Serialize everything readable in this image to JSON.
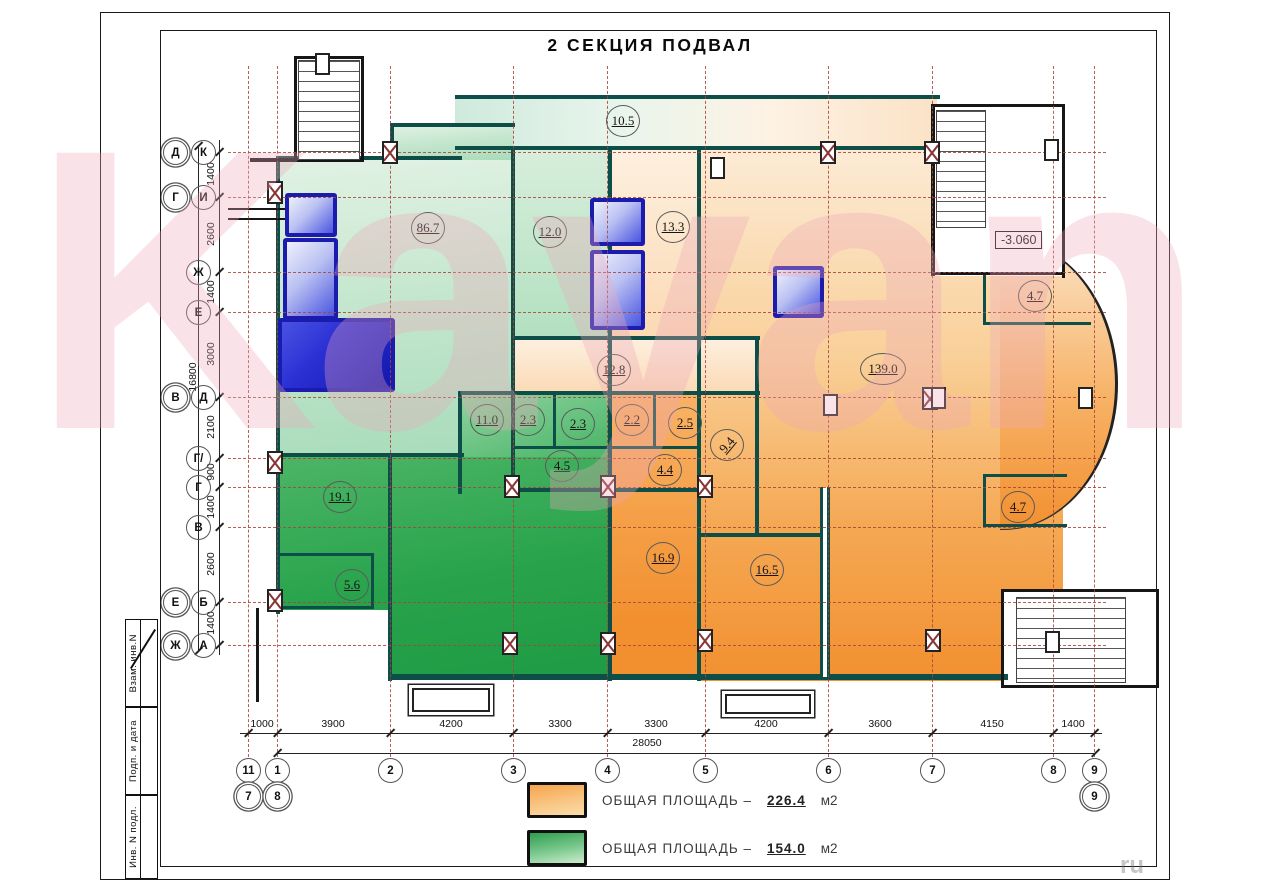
{
  "title": "2 СЕКЦИЯ ПОДВАЛ",
  "watermark": "Kayan",
  "watermark_small": "ru",
  "elevation": "-3.060",
  "legend": {
    "items": [
      {
        "color": "orange",
        "label": "ОБЩАЯ ПЛОЩАДЬ –",
        "value": "226.4",
        "unit": "м2"
      },
      {
        "color": "green",
        "label": "ОБЩАЯ ПЛОЩАДЬ –",
        "value": "154.0",
        "unit": "м2"
      }
    ]
  },
  "titleblock": {
    "cells": [
      "Взам. инв.N",
      "Подп. и дата",
      "Инв. N подл."
    ]
  },
  "rooms": [
    {
      "area": "10.5",
      "x": 623,
      "y": 121
    },
    {
      "area": "86.7",
      "x": 428,
      "y": 228
    },
    {
      "area": "12.0",
      "x": 550,
      "y": 232
    },
    {
      "area": "13.3",
      "x": 673,
      "y": 227
    },
    {
      "area": "12.8",
      "x": 614,
      "y": 370
    },
    {
      "area": "139.0",
      "x": 883,
      "y": 369,
      "wide": true
    },
    {
      "area": "4.7",
      "x": 1035,
      "y": 296
    },
    {
      "area": "11.0",
      "x": 487,
      "y": 420
    },
    {
      "area": "2.3",
      "x": 528,
      "y": 420
    },
    {
      "area": "2.3",
      "x": 578,
      "y": 424
    },
    {
      "area": "2.2",
      "x": 632,
      "y": 420
    },
    {
      "area": "2.5",
      "x": 685,
      "y": 423
    },
    {
      "area": "9.4",
      "x": 727,
      "y": 445,
      "rot": true
    },
    {
      "area": "4.5",
      "x": 562,
      "y": 466
    },
    {
      "area": "4.4",
      "x": 665,
      "y": 470
    },
    {
      "area": "19.1",
      "x": 340,
      "y": 497
    },
    {
      "area": "5.6",
      "x": 352,
      "y": 585
    },
    {
      "area": "16.9",
      "x": 663,
      "y": 558
    },
    {
      "area": "16.5",
      "x": 767,
      "y": 570
    },
    {
      "area": "4.7",
      "x": 1018,
      "y": 507
    }
  ],
  "axes": {
    "left": [
      {
        "a": "Д",
        "b": "К",
        "y": 152
      },
      {
        "a": "Г",
        "b": "И",
        "y": 197
      },
      {
        "a": "Ж",
        "y": 272
      },
      {
        "a": "Е",
        "y": 312
      },
      {
        "a": "В",
        "b": "Д",
        "y": 397
      },
      {
        "a": "Г/",
        "y": 458
      },
      {
        "a": "Г",
        "y": 487
      },
      {
        "a": "В",
        "y": 527
      },
      {
        "a": "Е",
        "b": "Б",
        "y": 602
      },
      {
        "a": "Ж",
        "b": "А",
        "y": 645
      }
    ],
    "bottom": [
      {
        "n": "11",
        "x": 248,
        "m": "7"
      },
      {
        "n": "1",
        "x": 277,
        "m": "8"
      },
      {
        "n": "2",
        "x": 390
      },
      {
        "n": "3",
        "x": 513
      },
      {
        "n": "4",
        "x": 607
      },
      {
        "n": "5",
        "x": 705
      },
      {
        "n": "6",
        "x": 828
      },
      {
        "n": "7",
        "x": 932
      },
      {
        "n": "8",
        "x": 1053
      },
      {
        "n": "9",
        "x": 1094,
        "m": "9"
      }
    ]
  },
  "dims": {
    "bottom": [
      {
        "v": "1000",
        "x": 262
      },
      {
        "v": "3900",
        "x": 333
      },
      {
        "v": "4200",
        "x": 451
      },
      {
        "v": "3300",
        "x": 560
      },
      {
        "v": "3300",
        "x": 656
      },
      {
        "v": "4200",
        "x": 766
      },
      {
        "v": "3600",
        "x": 880
      },
      {
        "v": "4150",
        "x": 992
      },
      {
        "v": "1400",
        "x": 1073
      }
    ],
    "bottom_total": {
      "v": "28050",
      "x": 647,
      "y": 737
    },
    "left": [
      {
        "v": "1400",
        "y": 174
      },
      {
        "v": "2600",
        "y": 234
      },
      {
        "v": "1400",
        "y": 292
      },
      {
        "v": "3000",
        "y": 354
      },
      {
        "v": "2100",
        "y": 427
      },
      {
        "v": "900",
        "y": 472
      },
      {
        "v": "1400",
        "y": 507
      },
      {
        "v": "2600",
        "y": 564
      },
      {
        "v": "1400",
        "y": 623
      }
    ],
    "left_total": {
      "v": "16800",
      "x": 193,
      "y": 377
    }
  },
  "plan": {
    "zones": [
      {
        "t": "rb",
        "x": 700,
        "y": 148,
        "w": 365,
        "h": 533
      },
      {
        "t": "pe",
        "x": 610,
        "y": 148,
        "w": 90,
        "h": 192
      },
      {
        "t": "st",
        "x": 455,
        "y": 97,
        "w": 482,
        "h": 53
      },
      {
        "t": "lg",
        "x": 278,
        "y": 158,
        "w": 235,
        "h": 299
      },
      {
        "t": "lg",
        "x": 390,
        "y": 125,
        "w": 123,
        "h": 35
      },
      {
        "t": "lg2",
        "x": 513,
        "y": 148,
        "w": 97,
        "h": 192
      },
      {
        "t": "pe",
        "x": 513,
        "y": 338,
        "w": 245,
        "h": 57
      },
      {
        "t": "mg",
        "x": 458,
        "y": 395,
        "w": 152,
        "h": 97
      },
      {
        "t": "sg",
        "x": 278,
        "y": 457,
        "w": 332,
        "h": 221
      },
      {
        "t": "so",
        "x": 610,
        "y": 395,
        "w": 90,
        "h": 283
      },
      {
        "t": "wh",
        "x": 1063,
        "y": 78,
        "w": 140,
        "h": 622
      },
      {
        "t": "bu",
        "x": 1000,
        "y": 238,
        "w": 118,
        "h": 292
      },
      {
        "t": "wh",
        "x": 933,
        "y": 106,
        "w": 132,
        "h": 170
      },
      {
        "t": "wh",
        "x": 1001,
        "y": 591,
        "w": 158,
        "h": 97
      },
      {
        "t": "wh",
        "x": 258,
        "y": 610,
        "w": 132,
        "h": 92
      }
    ],
    "walls_teal": [
      [
        455,
        95,
        485,
        4
      ],
      [
        278,
        156,
        184,
        4
      ],
      [
        455,
        146,
        485,
        4
      ],
      [
        276,
        156,
        4,
        458
      ],
      [
        511,
        146,
        4,
        348
      ],
      [
        608,
        146,
        4,
        535
      ],
      [
        697,
        146,
        4,
        535
      ],
      [
        511,
        336,
        249,
        4
      ],
      [
        458,
        391,
        302,
        4
      ],
      [
        458,
        391,
        4,
        103
      ],
      [
        276,
        453,
        188,
        4
      ],
      [
        553,
        395,
        3,
        54
      ],
      [
        653,
        395,
        3,
        54
      ],
      [
        511,
        446,
        190,
        3
      ],
      [
        511,
        488,
        190,
        4
      ],
      [
        755,
        336,
        4,
        200
      ],
      [
        697,
        533,
        128,
        4
      ],
      [
        276,
        553,
        98,
        3
      ],
      [
        276,
        606,
        98,
        3
      ],
      [
        371,
        553,
        3,
        55
      ],
      [
        388,
        453,
        4,
        228
      ],
      [
        388,
        674,
        620,
        6
      ],
      [
        983,
        273,
        3,
        52
      ],
      [
        983,
        322,
        108,
        3
      ],
      [
        983,
        474,
        3,
        53
      ],
      [
        983,
        474,
        84,
        3
      ],
      [
        983,
        524,
        84,
        3
      ],
      [
        390,
        123,
        125,
        4
      ],
      [
        390,
        123,
        4,
        37
      ]
    ],
    "wall_double": [
      [
        820,
        487,
        10,
        190
      ]
    ],
    "walls_black": [
      [
        294,
        56,
        3,
        106
      ],
      [
        361,
        56,
        3,
        106
      ],
      [
        294,
        56,
        70,
        3
      ],
      [
        250,
        158,
        114,
        4
      ],
      [
        931,
        106,
        4,
        170
      ],
      [
        931,
        104,
        134,
        3
      ],
      [
        1062,
        104,
        3,
        174
      ],
      [
        931,
        272,
        134,
        3
      ],
      [
        1001,
        589,
        3,
        99
      ],
      [
        1001,
        589,
        158,
        3
      ],
      [
        1156,
        589,
        3,
        99
      ],
      [
        1001,
        685,
        158,
        3
      ],
      [
        256,
        608,
        3,
        94
      ],
      [
        228,
        208,
        74,
        2
      ],
      [
        228,
        218,
        74,
        2
      ]
    ],
    "shafts": [
      {
        "x": 285,
        "y": 193,
        "w": 52,
        "h": 44
      },
      {
        "x": 283,
        "y": 238,
        "w": 55,
        "h": 82
      },
      {
        "x": 278,
        "y": 318,
        "w": 117,
        "h": 74,
        "deep": true
      },
      {
        "x": 590,
        "y": 198,
        "w": 55,
        "h": 48
      },
      {
        "x": 590,
        "y": 250,
        "w": 55,
        "h": 80
      },
      {
        "x": 773,
        "y": 266,
        "w": 51,
        "h": 52
      }
    ],
    "stairs": [
      [
        298,
        60,
        62,
        100
      ],
      [
        936,
        110,
        50,
        118
      ],
      [
        1016,
        597,
        110,
        86
      ]
    ],
    "columns_hatched": [
      [
        275,
        192
      ],
      [
        275,
        462
      ],
      [
        275,
        600
      ],
      [
        390,
        152
      ],
      [
        828,
        152
      ],
      [
        932,
        152
      ],
      [
        512,
        486
      ],
      [
        608,
        486
      ],
      [
        705,
        486
      ],
      [
        510,
        643
      ],
      [
        608,
        643
      ],
      [
        705,
        640
      ],
      [
        933,
        640
      ],
      [
        930,
        398
      ]
    ],
    "columns_plain": [
      [
        1052,
        642
      ],
      [
        1085,
        398
      ],
      [
        322,
        64
      ],
      [
        1051,
        150
      ],
      [
        830,
        405
      ],
      [
        938,
        398
      ],
      [
        717,
        168
      ]
    ],
    "porches": [
      [
        412,
        688,
        78,
        24
      ],
      [
        725,
        694,
        86,
        20
      ]
    ],
    "grid": {
      "v": [
        248,
        277,
        390,
        513,
        607,
        705,
        828,
        932,
        1053,
        1094
      ],
      "vspan": [
        66,
        757
      ],
      "h": [
        152,
        197,
        272,
        312,
        397,
        458,
        487,
        527,
        602,
        645
      ],
      "hspan": [
        228,
        1106
      ]
    },
    "dimlines": {
      "bottom": [
        240,
        733,
        862
      ],
      "bottom2": [
        277,
        753,
        818
      ],
      "left": [
        219,
        140,
        515
      ],
      "left2": [
        198,
        146,
        505
      ]
    }
  },
  "colors": {
    "wall_teal": "#0d4f48",
    "grid_red": "#a8443a",
    "shaft_blue": "#1b1bae",
    "legend_orange": "#f6a44c",
    "legend_green": "#2f9e4e",
    "watermark_pink": "#eca8b8"
  }
}
